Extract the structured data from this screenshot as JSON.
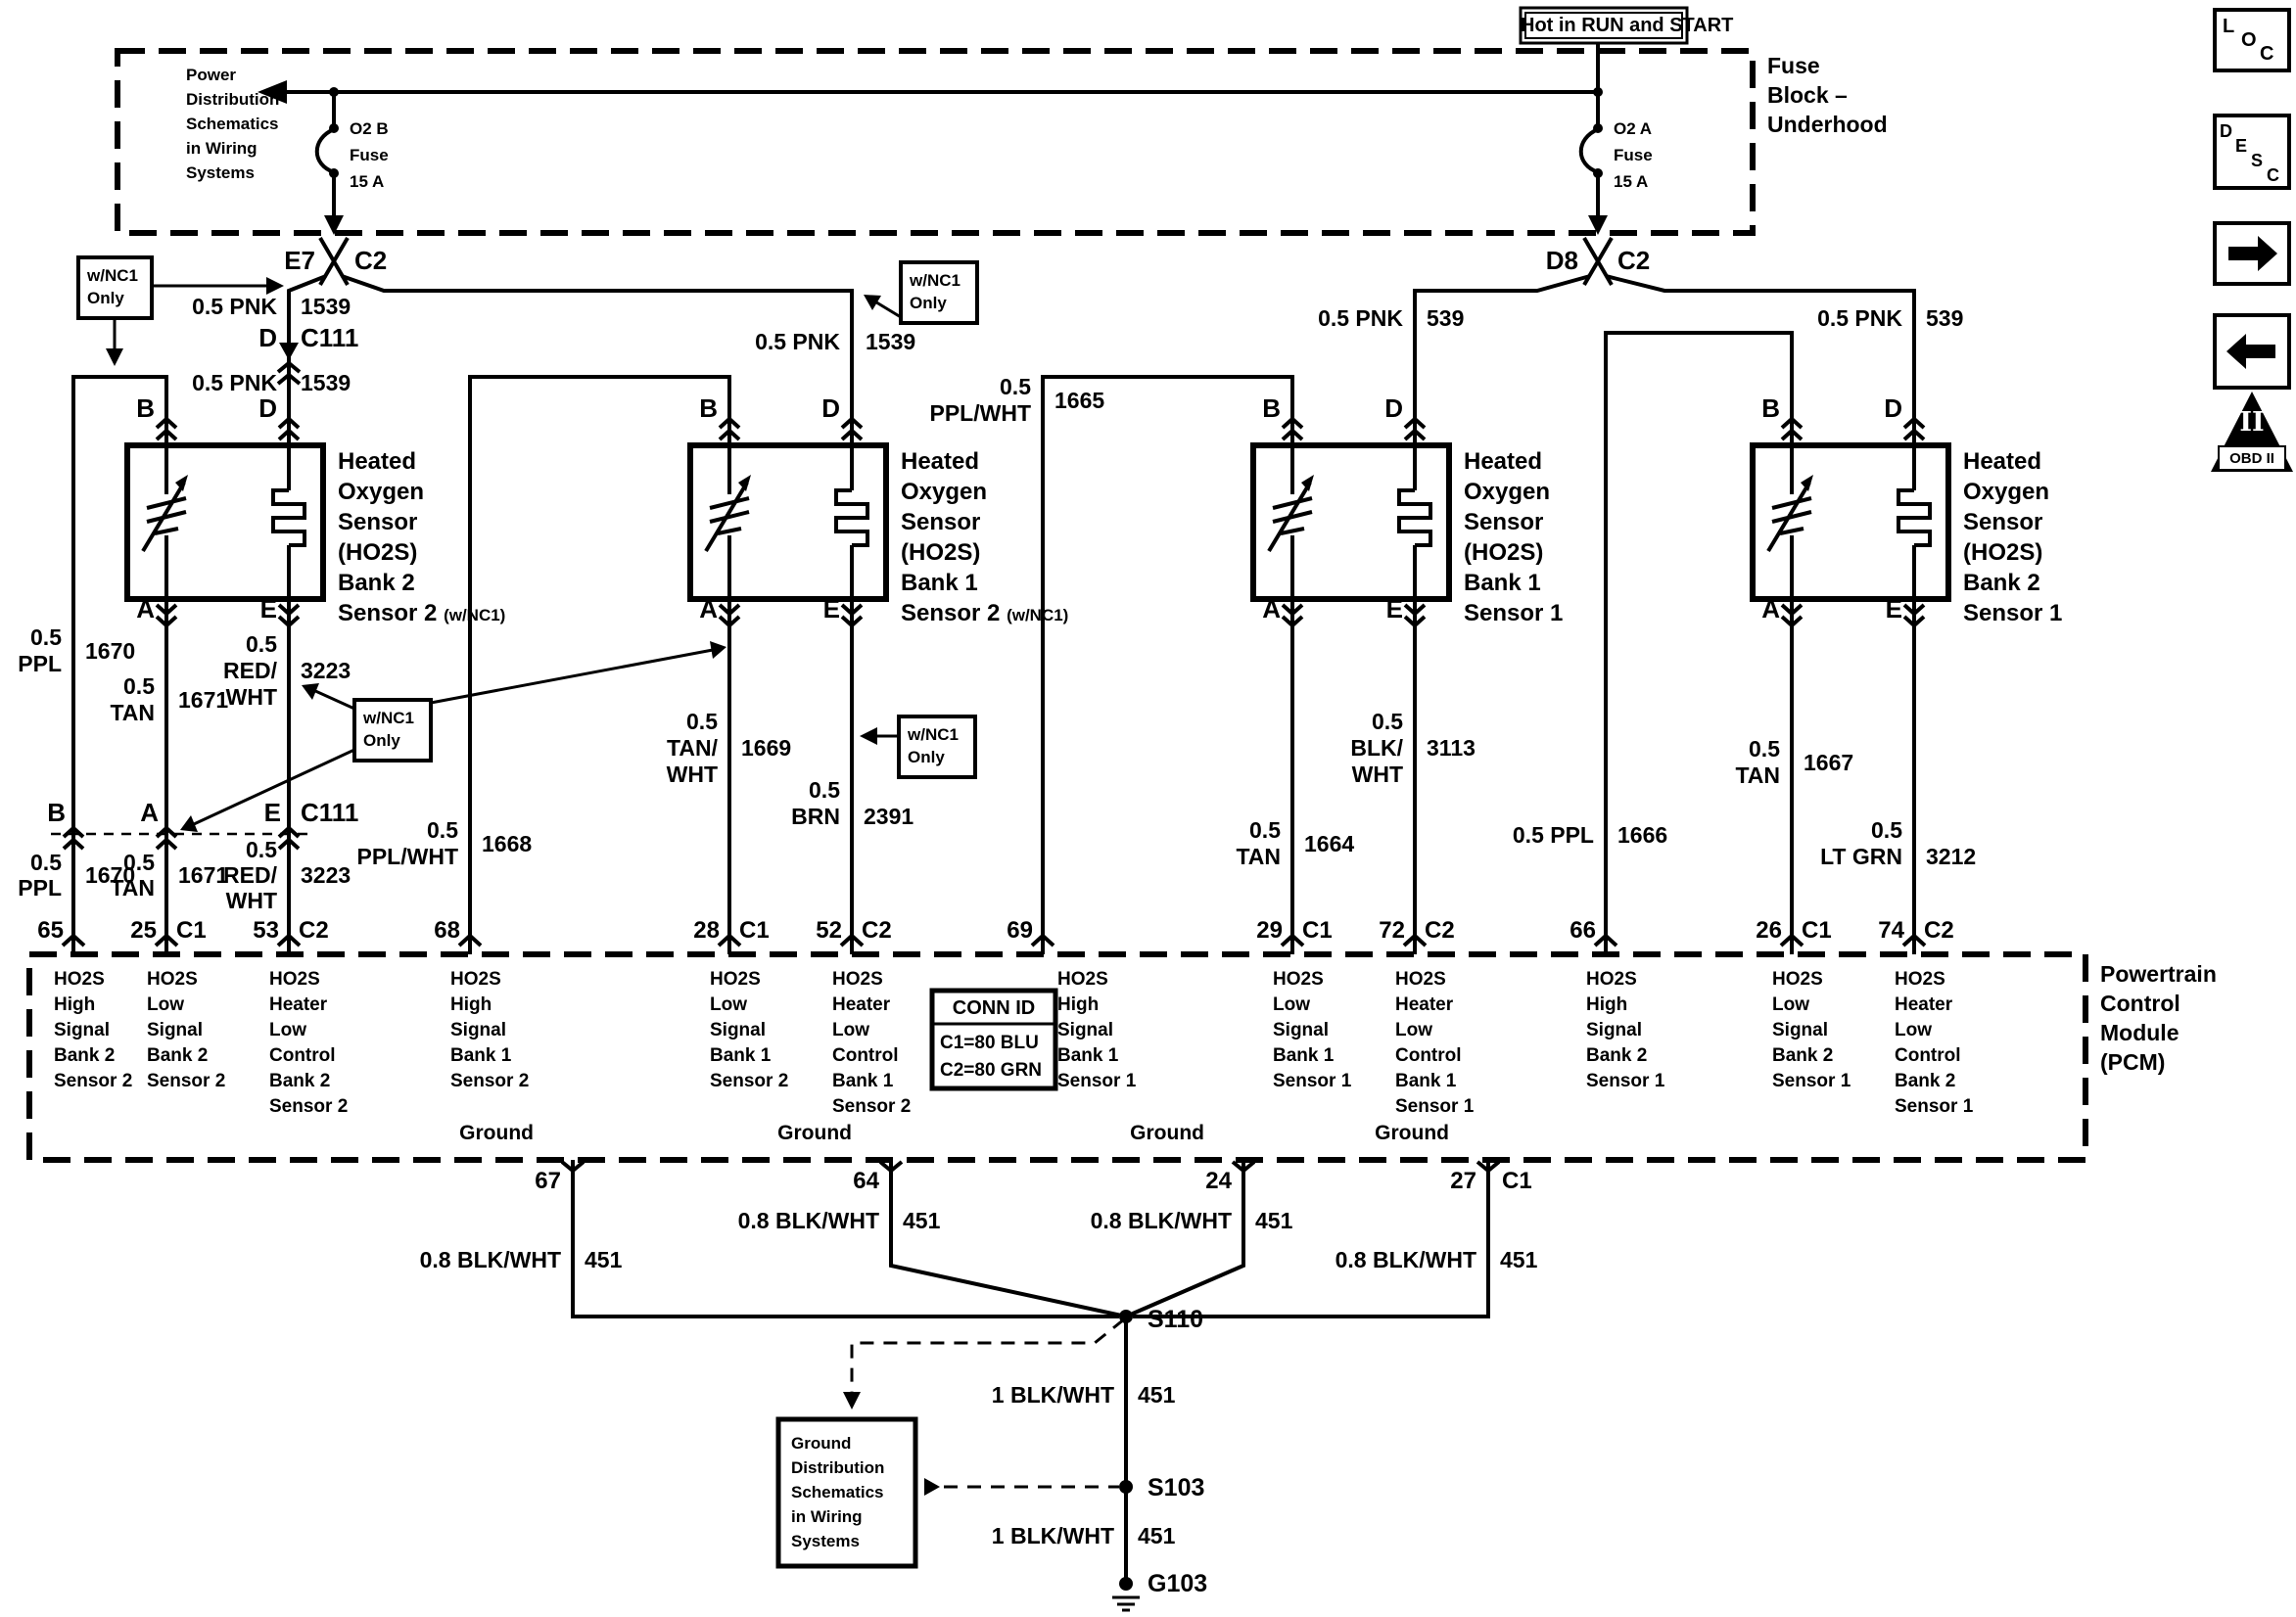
{
  "header": {
    "hot_label": "Hot in RUN and START",
    "fuse_block_title": [
      "Fuse",
      "Block –",
      "Underhood"
    ],
    "power_note": [
      "Power",
      "Distribution",
      "Schematics",
      "in Wiring",
      "Systems"
    ],
    "fuse_left": [
      "O2 B",
      "Fuse",
      "15 A"
    ],
    "fuse_right": [
      "O2 A",
      "Fuse",
      "15 A"
    ],
    "breakout_left": {
      "pin": "E7",
      "conn": "C2"
    },
    "breakout_right": {
      "pin": "D8",
      "conn": "C2"
    }
  },
  "nc1_note": [
    "w/NC1",
    "Only"
  ],
  "terminals": {
    "b": "B",
    "d": "D",
    "a": "A",
    "e": "E"
  },
  "sensors": [
    {
      "title": [
        "Heated",
        "Oxygen",
        "Sensor",
        "(HO2S)",
        "Bank 2"
      ],
      "last": "Sensor 2",
      "suffix": "(w/NC1)"
    },
    {
      "title": [
        "Heated",
        "Oxygen",
        "Sensor",
        "(HO2S)",
        "Bank 1"
      ],
      "last": "Sensor 2",
      "suffix": "(w/NC1)"
    },
    {
      "title": [
        "Heated",
        "Oxygen",
        "Sensor",
        "(HO2S)",
        "Bank 1"
      ],
      "last": "Sensor 1",
      "suffix": ""
    },
    {
      "title": [
        "Heated",
        "Oxygen",
        "Sensor",
        "(HO2S)",
        "Bank 2"
      ],
      "last": "Sensor 1",
      "suffix": ""
    }
  ],
  "wires": {
    "c111_label": "C111",
    "feed_a": {
      "label": [
        "0.5 PNK"
      ],
      "circuit": "1539"
    },
    "feed_b": {
      "label": [
        "0.5 PNK"
      ],
      "circuit": "1539"
    },
    "feed_c": {
      "label": [
        "0.5 PNK"
      ],
      "circuit": "539"
    },
    "feed_d": {
      "label": [
        "0.5 PNK"
      ],
      "circuit": "539"
    },
    "a_b": {
      "label": [
        "0.5",
        "PPL"
      ],
      "circuit": "1670"
    },
    "a_a": {
      "label": [
        "0.5",
        "TAN"
      ],
      "circuit": "1671"
    },
    "a_e": {
      "label": [
        "0.5",
        "RED/",
        "WHT"
      ],
      "circuit": "3223"
    },
    "b_b": {
      "label": [
        "0.5",
        "PPL/WHT"
      ],
      "circuit": "1668"
    },
    "b_a": {
      "label": [
        "0.5",
        "TAN/",
        "WHT"
      ],
      "circuit": "1669"
    },
    "b_e": {
      "label": [
        "0.5",
        "BRN"
      ],
      "circuit": "2391"
    },
    "c_b": {
      "label": [
        "0.5",
        "PPL/WHT"
      ],
      "circuit": "1665"
    },
    "c_a": {
      "label": [
        "0.5",
        "TAN"
      ],
      "circuit": "1664"
    },
    "c_e": {
      "label": [
        "0.5",
        "BLK/",
        "WHT"
      ],
      "circuit": "3113"
    },
    "d_b": {
      "label": [
        "0.5 PPL"
      ],
      "circuit": "1666"
    },
    "d_a": {
      "label": [
        "0.5",
        "TAN"
      ],
      "circuit": "1667"
    },
    "d_e": {
      "label": [
        "0.5",
        "LT GRN"
      ],
      "circuit": "3212"
    },
    "gnd_67": {
      "label": [
        "0.8 BLK/WHT"
      ],
      "circuit": "451"
    },
    "gnd_64": {
      "label": [
        "0.8 BLK/WHT"
      ],
      "circuit": "451"
    },
    "gnd_24": {
      "label": [
        "0.8 BLK/WHT"
      ],
      "circuit": "451"
    },
    "gnd_27": {
      "label": [
        "0.8 BLK/WHT"
      ],
      "circuit": "451"
    },
    "gnd_s110": {
      "label": [
        "1 BLK/WHT"
      ],
      "circuit": "451"
    },
    "gnd_s103": {
      "label": [
        "1 BLK/WHT"
      ],
      "circuit": "451"
    }
  },
  "pcm": {
    "title": [
      "Powertrain",
      "Control",
      "Module",
      "(PCM)"
    ],
    "pins_top": [
      {
        "num": "65",
        "conn": ""
      },
      {
        "num": "25",
        "conn": "C1"
      },
      {
        "num": "53",
        "conn": "C2"
      },
      {
        "num": "68",
        "conn": ""
      },
      {
        "num": "28",
        "conn": "C1"
      },
      {
        "num": "52",
        "conn": "C2"
      },
      {
        "num": "69",
        "conn": ""
      },
      {
        "num": "29",
        "conn": "C1"
      },
      {
        "num": "72",
        "conn": "C2"
      },
      {
        "num": "66",
        "conn": ""
      },
      {
        "num": "26",
        "conn": "C1"
      },
      {
        "num": "74",
        "conn": "C2"
      }
    ],
    "functions": [
      [
        "HO2S",
        "High",
        "Signal",
        "Bank 2",
        "Sensor 2"
      ],
      [
        "HO2S",
        "Low",
        "Signal",
        "Bank 2",
        "Sensor 2"
      ],
      [
        "HO2S",
        "Heater",
        "Low",
        "Control",
        "Bank 2",
        "Sensor 2"
      ],
      [
        "HO2S",
        "High",
        "Signal",
        "Bank 1",
        "Sensor 2"
      ],
      [
        "HO2S",
        "Low",
        "Signal",
        "Bank 1",
        "Sensor 2"
      ],
      [
        "HO2S",
        "Heater",
        "Low",
        "Control",
        "Bank 1",
        "Sensor 2"
      ],
      [
        "HO2S",
        "High",
        "Signal",
        "Bank 1",
        "Sensor 1"
      ],
      [
        "HO2S",
        "Low",
        "Signal",
        "Bank 1",
        "Sensor 1"
      ],
      [
        "HO2S",
        "Heater",
        "Low",
        "Control",
        "Bank 1",
        "Sensor 1"
      ],
      [
        "HO2S",
        "High",
        "Signal",
        "Bank 2",
        "Sensor 1"
      ],
      [
        "HO2S",
        "Low",
        "Signal",
        "Bank 2",
        "Sensor 1"
      ],
      [
        "HO2S",
        "Heater",
        "Low",
        "Control",
        "Bank 2",
        "Sensor 1"
      ]
    ],
    "ground_label": "Ground",
    "pins_bottom": [
      {
        "num": "67",
        "conn": ""
      },
      {
        "num": "64",
        "conn": ""
      },
      {
        "num": "24",
        "conn": ""
      },
      {
        "num": "27",
        "conn": "C1"
      }
    ],
    "conn_id": {
      "title": "CONN ID",
      "rows": [
        "C1=80 BLU",
        "C2=80 GRN"
      ]
    }
  },
  "splices": {
    "s110": "S110",
    "s103": "S103",
    "g103": "G103"
  },
  "ground_note": [
    "Ground",
    "Distribution",
    "Schematics",
    "in Wiring",
    "Systems"
  ],
  "icons": {
    "loc": [
      "L",
      "O",
      "C"
    ],
    "desc": [
      "D",
      "E",
      "S",
      "C"
    ],
    "obd_numeral": "II",
    "obd_label": "OBD II"
  }
}
